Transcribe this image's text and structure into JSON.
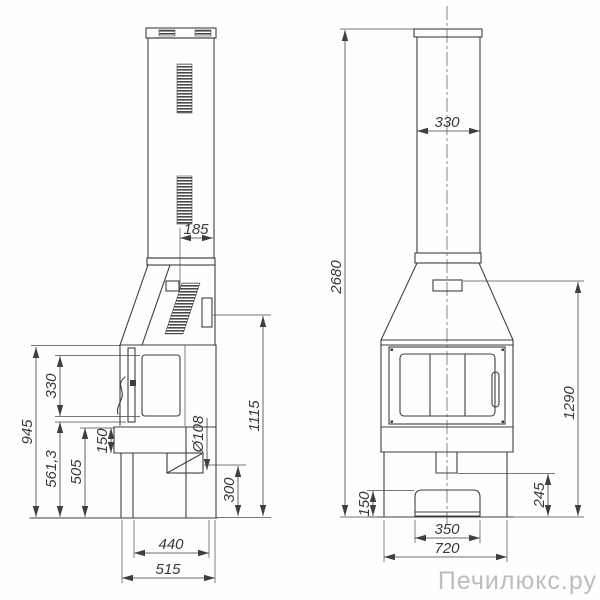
{
  "watermark": "Печилюкс.ру",
  "colors": {
    "line": "#3f3f3f",
    "dim_text": "#3a3a3a",
    "watermark": "#bdbdbd",
    "background": "#ffffff"
  },
  "side_view": {
    "dims": {
      "flue_duct_depth": "185",
      "firebox_top_height": "945",
      "door_glass_height": "330",
      "lower_height": "561,3",
      "plinth_top_height": "505",
      "shelf_height": "150",
      "flue_diameter": "Ø108",
      "outlet_bottom_height": "300",
      "side_outlet_axis_height": "1115",
      "body_depth": "440",
      "base_depth": "515"
    }
  },
  "front_view": {
    "dims": {
      "chimney_width": "330",
      "total_height": "2680",
      "hood_height": "1290",
      "ash_gap_height": "245",
      "drawer_height": "150",
      "drawer_width": "350",
      "body_width": "720"
    }
  }
}
